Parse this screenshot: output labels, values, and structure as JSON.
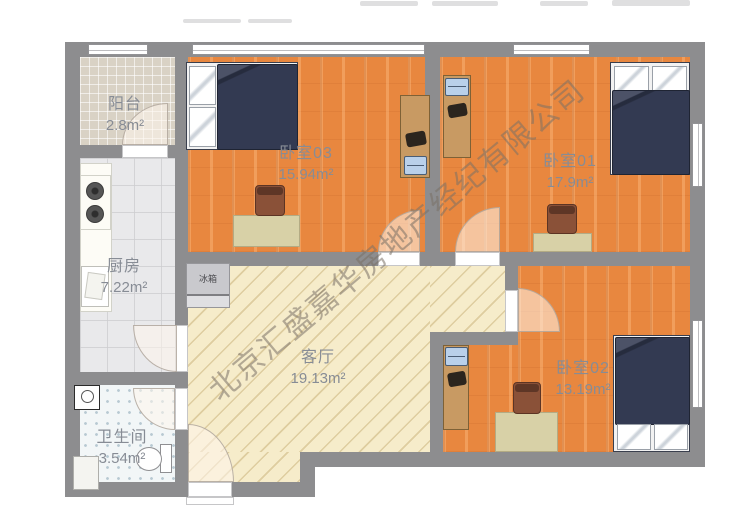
{
  "watermark": "北京汇盛嘉华房地产经纪有限公司",
  "rooms": {
    "balcony": {
      "name": "阳台",
      "area": "2.8m²"
    },
    "kitchen": {
      "name": "厨房",
      "area": "7.22m²"
    },
    "bathroom": {
      "name": "卫生间",
      "area": "3.54m²"
    },
    "living": {
      "name": "客厅",
      "area": "19.13m²"
    },
    "bedroom3": {
      "name": "卧室03",
      "area": "15.94m²"
    },
    "bedroom1": {
      "name": "卧室01",
      "area": "17.9m²"
    },
    "bedroom2": {
      "name": "卧室02",
      "area": "13.19m²"
    }
  },
  "appliances": {
    "fridge": "冰箱"
  },
  "colors": {
    "wall": "#8d8d8f",
    "bedroom_floor": "#e8873f",
    "living_floor": "#f6ecca",
    "balcony_floor": "#d9d2c5",
    "kitchen_floor": "#e9e9eb",
    "bathroom_floor": "#f2f6f7",
    "bed_duvet": "#333a52",
    "desk": "#c89a63",
    "label_text": "#878c95"
  }
}
